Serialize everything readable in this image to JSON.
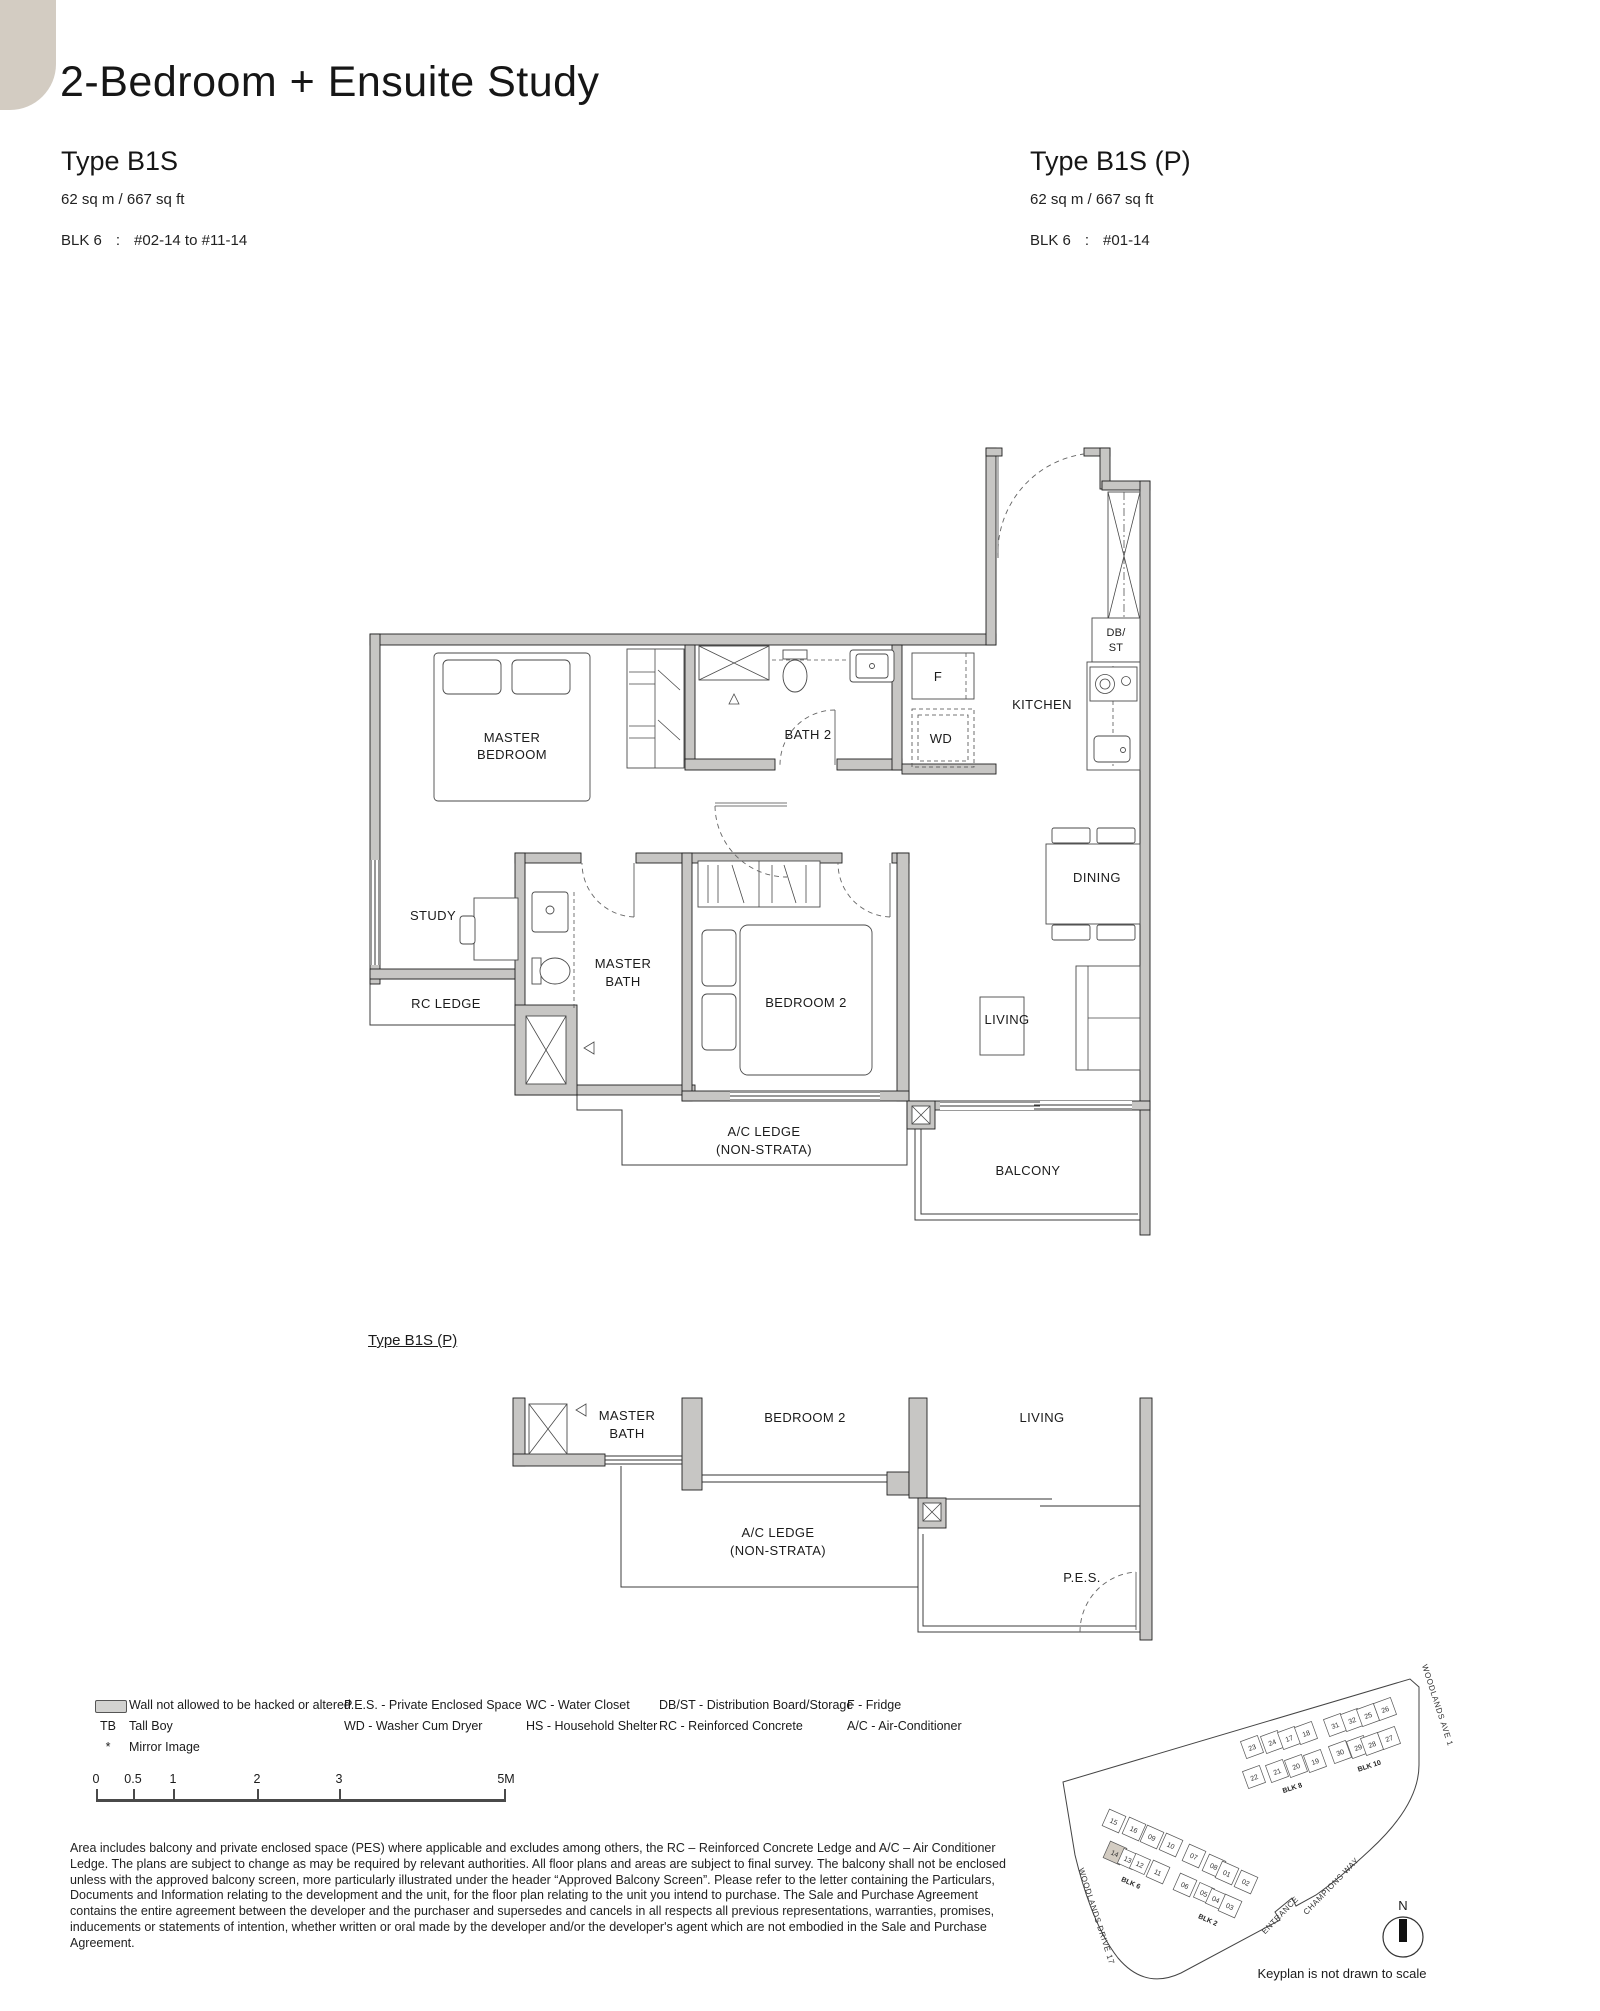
{
  "page": {
    "title": "2-Bedroom + Ensuite Study",
    "unit_left": {
      "type": "Type B1S",
      "area": "62 sq m /  667 sq ft",
      "blk": "BLK 6",
      "sep": ":",
      "levels": "#02-14 to #11-14"
    },
    "unit_right": {
      "type": "Type B1S (P)",
      "area": "62 sq m /  667 sq ft",
      "blk": "BLK 6",
      "sep": ":",
      "levels": "#01-14"
    }
  },
  "main_plan": {
    "rooms": {
      "master_bedroom": [
        "MASTER",
        "BEDROOM"
      ],
      "bath2": "BATH 2",
      "kitchen": "KITCHEN",
      "dbst": [
        "DB/",
        "ST"
      ],
      "fridge": "F",
      "wd": "WD",
      "dining": "DINING",
      "study": "STUDY",
      "rc_ledge": "RC LEDGE",
      "master_bath": [
        "MASTER",
        "BATH"
      ],
      "bedroom2": "BEDROOM 2",
      "living": "LIVING",
      "ac_ledge": [
        "A/C LEDGE",
        "(NON-STRATA)"
      ],
      "balcony": "BALCONY"
    }
  },
  "partial_plan": {
    "heading": "Type B1S (P)",
    "rooms": {
      "master_bath": [
        "MASTER",
        "BATH"
      ],
      "bedroom2": "BEDROOM 2",
      "living": "LIVING",
      "ac_ledge": [
        "A/C LEDGE",
        "(NON-STRATA)"
      ],
      "pes": "P.E.S."
    }
  },
  "legend": {
    "col1": [
      {
        "key": "",
        "label": "Wall not allowed to be hacked or altered"
      },
      {
        "key": "TB",
        "label": "Tall Boy"
      },
      {
        "key": "*",
        "label": "Mirror Image"
      }
    ],
    "col2": [
      "P.E.S. - Private Enclosed Space",
      "WD - Washer Cum Dryer"
    ],
    "col3": [
      "WC - Water Closet",
      "HS - Household Shelter"
    ],
    "col4": [
      "DB/ST - Distribution Board/Storage",
      "RC - Reinforced Concrete"
    ],
    "col5": [
      "F - Fridge",
      "A/C - Air-Conditioner"
    ]
  },
  "scalebar": {
    "labels": [
      "0",
      "0.5",
      "1",
      "2",
      "3",
      "5M"
    ]
  },
  "disclaimer": "Area includes balcony and private enclosed space (PES) where applicable and excludes among others, the RC – Reinforced Concrete Ledge and A/C – Air Conditioner Ledge. The plans are subject to change as may be required by relevant authorities. All floor plans and areas are subject to final survey. The balcony shall not be enclosed unless with the approved balcony screen, more particularly illustrated under the header “Approved Balcony Screen”. Please refer to the letter containing the Particulars, Documents and Information relating to the development and the unit, for the floor plan relating to the unit you intend to purchase. The Sale and Purchase Agreement contains the entire agreement between the developer and the purchaser and supersedes and cancels in all respects all previous representations, warranties, promises, inducements or statements of intention, whether written or oral made by the developer and/or the developer's agent which are not embodied in the Sale and Purchase Agreement.",
  "keyplan": {
    "blocks": {
      "blk2": "BLK 2",
      "blk6": "BLK 6",
      "blk8": "BLK 8",
      "blk10": "BLK 10"
    },
    "roads": {
      "ave1": "WOODLANDS AVE 1",
      "drive17": "WOODLANDS DRIVE 17",
      "champions": "CHAMPIONS WAY",
      "entrance": "ENTRANCE"
    },
    "north": "N",
    "caption": "Keyplan is not drawn to scale",
    "units_upper_top": [
      "23",
      "24",
      "17",
      "18",
      "31",
      "32",
      "25",
      "26"
    ],
    "units_upper_bottom": [
      "22",
      "21",
      "20",
      "19",
      "30",
      "29",
      "28",
      "27"
    ],
    "units_lower_top": [
      "15",
      "16",
      "09",
      "10",
      "07",
      "08",
      "01",
      "02"
    ],
    "units_lower_bottom": [
      "14",
      "13",
      "12",
      "11",
      "06",
      "05",
      "04",
      "03"
    ],
    "highlighted_unit": "14"
  },
  "colors": {
    "accent_beige": "#d3ccc2",
    "wall_gray": "#c7c6c4",
    "swatch_gray": "#d2d2d0"
  }
}
